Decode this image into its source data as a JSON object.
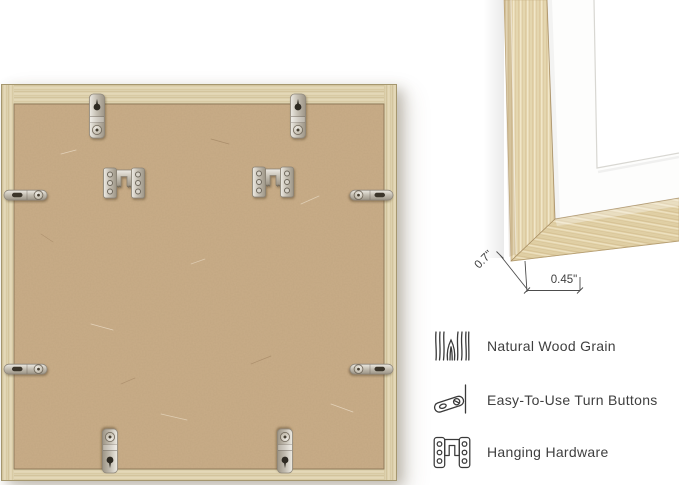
{
  "corner_detail": {
    "depth": "0.7\"",
    "face_width": "0.45\""
  },
  "features": [
    {
      "icon": "wood-grain-icon",
      "label": "Natural Wood Grain"
    },
    {
      "icon": "turn-button-icon",
      "label": "Easy-To-Use Turn Buttons"
    },
    {
      "icon": "hanging-hardware-icon",
      "label": "Hanging Hardware"
    }
  ],
  "back_view": {
    "hardware": {
      "keyhole_hangers": 4,
      "turn_buttons": 4,
      "hanging_brackets": 2
    }
  },
  "colors": {
    "background": "#ffffff",
    "frame_wood": "#ddd1ae",
    "detail_wood": "#e6d8b2",
    "mdf_back": "#c9ad88",
    "metal": "#c6c0b4",
    "text": "#3f3f3f",
    "dimension_lines": "#4c4c4c"
  }
}
